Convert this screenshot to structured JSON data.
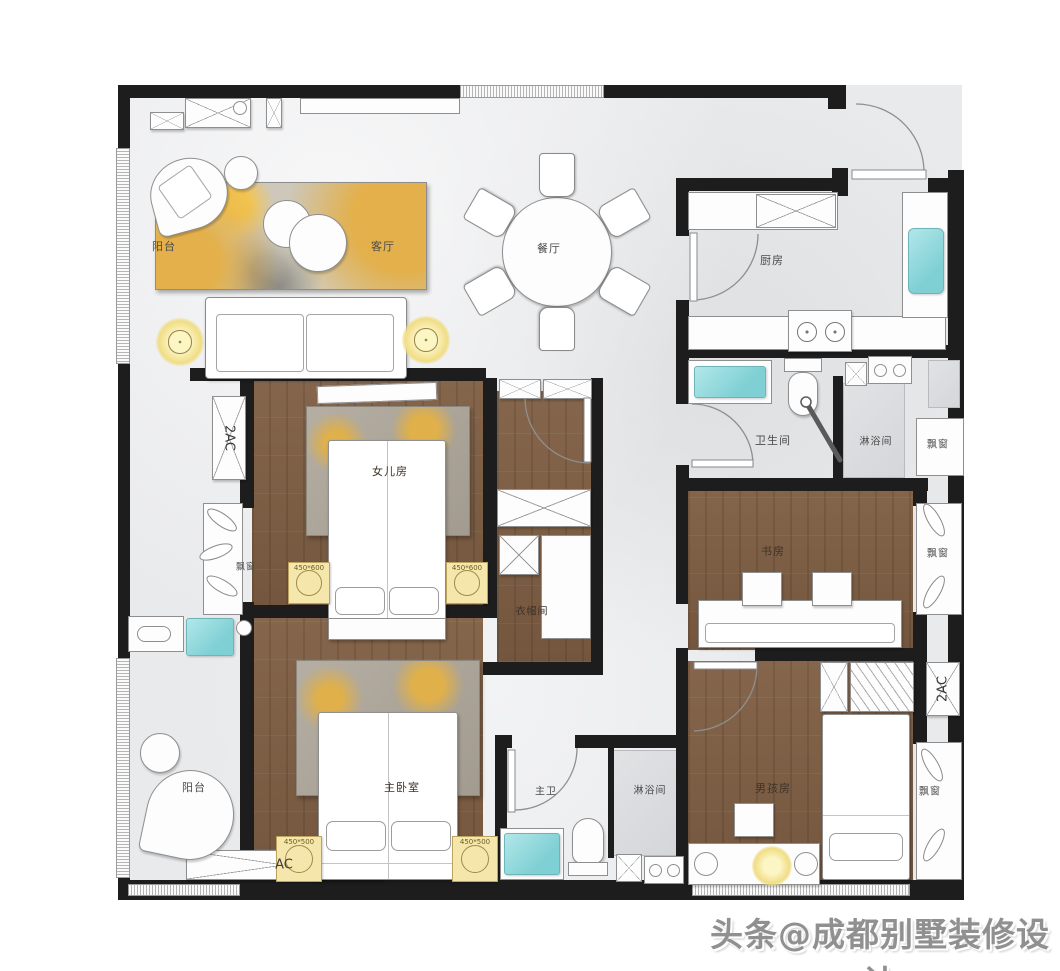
{
  "palette": {
    "wall": "#1d1d1d",
    "wood_floor": "#7c5d44",
    "marble_floor": "#e9eaec",
    "teal_fixture": "#7fd0d4",
    "lamp_yellow": "#f0dd85",
    "rug_yellow": "#e3b04a",
    "label_color": "#4a4a4a"
  },
  "rooms": {
    "balcony_top": "阳台",
    "living_room": "客厅",
    "dining_room": "餐厅",
    "kitchen": "厨房",
    "bathroom": "卫生间",
    "shower_room_top": "淋浴间",
    "bay_window_bath": "飘窗",
    "daughter_room": "女儿房",
    "bay_window_daughter": "飘窗",
    "cloakroom": "衣帽间",
    "study": "书房",
    "bay_window_study": "飘窗",
    "master_bedroom": "主卧室",
    "master_bathroom": "主卫",
    "shower_room_bottom": "淋浴间",
    "boy_room": "男孩房",
    "bay_window_boy": "飘窗",
    "balcony_bottom": "阳台"
  },
  "equipment": {
    "ac_left": "2AC",
    "ac_right": "2AC",
    "ac_bottom": "AC",
    "nightstand_daughter_left": "450*600",
    "nightstand_daughter_right": "450*600",
    "nightstand_master_left": "450*500",
    "nightstand_master_right": "450*500"
  },
  "watermark": {
    "text": "头条@成都别墅装修设计"
  }
}
